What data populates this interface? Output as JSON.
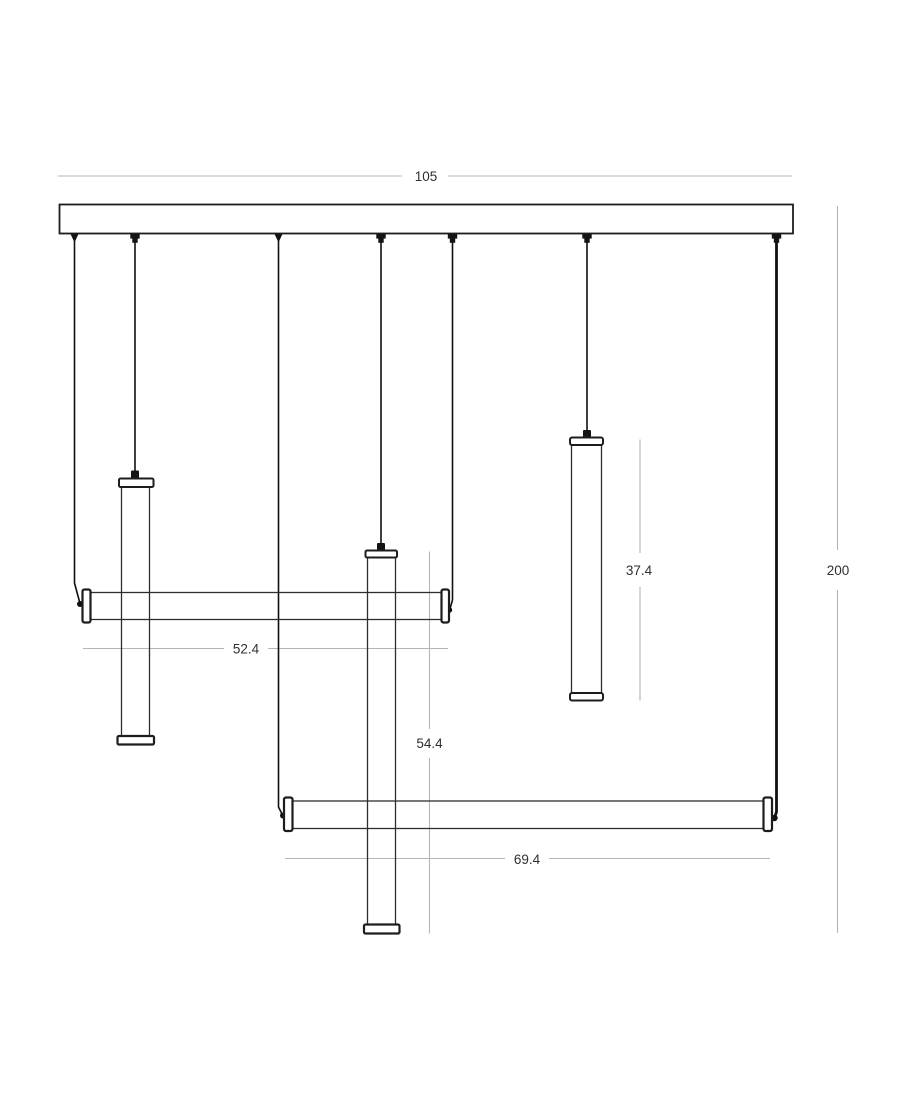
{
  "drawing": {
    "subject": "linear-multi-pendant-light-technical-drawing",
    "dimensions": {
      "canopy_length": "105",
      "overall_drop": "200",
      "upper_horizontal_tube": "52.4",
      "middle_vertical_tube": "54.4",
      "right_vertical_tube": "37.4",
      "lower_horizontal_tube": "69.4"
    },
    "colors": {
      "outline": "#1d1d1d",
      "cable": "#101010",
      "dimension_line": "#b5b5b5",
      "dimension_text": "#303030",
      "background": "#ffffff"
    }
  }
}
